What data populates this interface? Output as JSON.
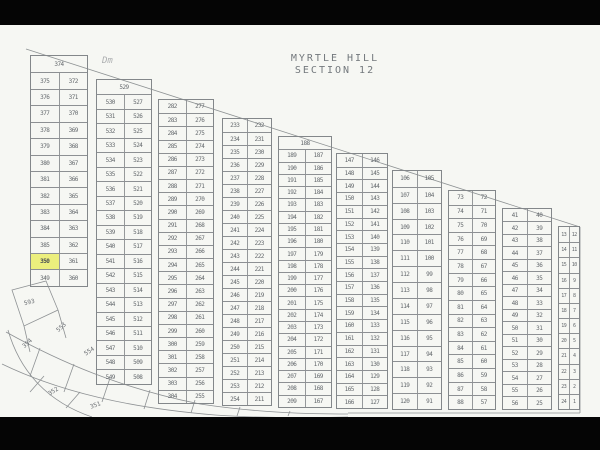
{
  "title": {
    "line1": "MYRTLE HILL",
    "line2": "SECTION 12"
  },
  "annotation": {
    "text": "Dm",
    "x": 102,
    "y": 56
  },
  "colors": {
    "paper": "#f6f7f3",
    "line": "#83878a",
    "text": "#565b60",
    "highlight": "#ecef74",
    "letterbox": "#050505"
  },
  "highlight": {
    "strip": 0,
    "row": 12,
    "col": 0,
    "lot": "350"
  },
  "strips": [
    {
      "x": 30,
      "w": 58,
      "top": 55,
      "bottom": 287,
      "fs": 6,
      "header": "374",
      "rows": [
        [
          "375",
          "372"
        ],
        [
          "376",
          "371"
        ],
        [
          "377",
          "370"
        ],
        [
          "378",
          "369"
        ],
        [
          "379",
          "368"
        ],
        [
          "380",
          "367"
        ],
        [
          "381",
          "366"
        ],
        [
          "382",
          "365"
        ],
        [
          "383",
          "364"
        ],
        [
          "384",
          "363"
        ],
        [
          "385",
          "362"
        ],
        [
          "350",
          "361"
        ],
        [
          "349",
          "360"
        ]
      ]
    },
    {
      "x": 96,
      "w": 56,
      "top": 79,
      "bottom": 385,
      "fs": 6,
      "header": "529",
      "rows": [
        [
          "530",
          "527"
        ],
        [
          "531",
          "526"
        ],
        [
          "532",
          "525"
        ],
        [
          "533",
          "524"
        ],
        [
          "534",
          "523"
        ],
        [
          "535",
          "522"
        ],
        [
          "536",
          "521"
        ],
        [
          "537",
          "520"
        ],
        [
          "538",
          "519"
        ],
        [
          "539",
          "518"
        ],
        [
          "540",
          "517"
        ],
        [
          "541",
          "516"
        ],
        [
          "542",
          "515"
        ],
        [
          "543",
          "514"
        ],
        [
          "544",
          "513"
        ],
        [
          "545",
          "512"
        ],
        [
          "546",
          "511"
        ],
        [
          "547",
          "510"
        ],
        [
          "548",
          "509"
        ],
        [
          "549",
          "508"
        ]
      ]
    },
    {
      "x": 158,
      "w": 56,
      "top": 99,
      "bottom": 404,
      "fs": 6,
      "header": "",
      "rows": [
        [
          "282",
          "277"
        ],
        [
          "283",
          "276"
        ],
        [
          "284",
          "275"
        ],
        [
          "285",
          "274"
        ],
        [
          "286",
          "273"
        ],
        [
          "287",
          "272"
        ],
        [
          "288",
          "271"
        ],
        [
          "289",
          "270"
        ],
        [
          "290",
          "269"
        ],
        [
          "291",
          "268"
        ],
        [
          "292",
          "267"
        ],
        [
          "293",
          "266"
        ],
        [
          "294",
          "265"
        ],
        [
          "295",
          "264"
        ],
        [
          "296",
          "263"
        ],
        [
          "297",
          "262"
        ],
        [
          "298",
          "261"
        ],
        [
          "299",
          "260"
        ],
        [
          "300",
          "259"
        ],
        [
          "301",
          "258"
        ],
        [
          "302",
          "257"
        ],
        [
          "303",
          "256"
        ],
        [
          "304",
          "255"
        ]
      ]
    },
    {
      "x": 222,
      "w": 50,
      "top": 118,
      "bottom": 406,
      "fs": 6,
      "header": "",
      "rows": [
        [
          "233",
          "232"
        ],
        [
          "234",
          "231"
        ],
        [
          "235",
          "230"
        ],
        [
          "236",
          "229"
        ],
        [
          "237",
          "228"
        ],
        [
          "238",
          "227"
        ],
        [
          "239",
          "226"
        ],
        [
          "240",
          "225"
        ],
        [
          "241",
          "224"
        ],
        [
          "242",
          "223"
        ],
        [
          "243",
          "222"
        ],
        [
          "244",
          "221"
        ],
        [
          "245",
          "220"
        ],
        [
          "246",
          "219"
        ],
        [
          "247",
          "218"
        ],
        [
          "248",
          "217"
        ],
        [
          "249",
          "216"
        ],
        [
          "250",
          "215"
        ],
        [
          "251",
          "214"
        ],
        [
          "252",
          "213"
        ],
        [
          "253",
          "212"
        ],
        [
          "254",
          "211"
        ]
      ]
    },
    {
      "x": 278,
      "w": 54,
      "top": 136,
      "bottom": 408,
      "fs": 6,
      "header": "188",
      "rows": [
        [
          "189",
          "187"
        ],
        [
          "190",
          "186"
        ],
        [
          "191",
          "185"
        ],
        [
          "192",
          "184"
        ],
        [
          "193",
          "183"
        ],
        [
          "194",
          "182"
        ],
        [
          "195",
          "181"
        ],
        [
          "196",
          "180"
        ],
        [
          "197",
          "179"
        ],
        [
          "198",
          "178"
        ],
        [
          "199",
          "177"
        ],
        [
          "200",
          "176"
        ],
        [
          "201",
          "175"
        ],
        [
          "202",
          "174"
        ],
        [
          "203",
          "173"
        ],
        [
          "204",
          "172"
        ],
        [
          "205",
          "171"
        ],
        [
          "206",
          "170"
        ],
        [
          "207",
          "169"
        ],
        [
          "208",
          "168"
        ],
        [
          "209",
          "167"
        ]
      ]
    },
    {
      "x": 336,
      "w": 52,
      "top": 153,
      "bottom": 409,
      "fs": 6,
      "header": "",
      "rows": [
        [
          "147",
          "146"
        ],
        [
          "148",
          "145"
        ],
        [
          "149",
          "144"
        ],
        [
          "150",
          "143"
        ],
        [
          "151",
          "142"
        ],
        [
          "152",
          "141"
        ],
        [
          "153",
          "140"
        ],
        [
          "154",
          "139"
        ],
        [
          "155",
          "138"
        ],
        [
          "156",
          "137"
        ],
        [
          "157",
          "136"
        ],
        [
          "158",
          "135"
        ],
        [
          "159",
          "134"
        ],
        [
          "160",
          "133"
        ],
        [
          "161",
          "132"
        ],
        [
          "162",
          "131"
        ],
        [
          "163",
          "130"
        ],
        [
          "164",
          "129"
        ],
        [
          "165",
          "128"
        ],
        [
          "166",
          "127"
        ]
      ]
    },
    {
      "x": 392,
      "w": 50,
      "top": 170,
      "bottom": 410,
      "fs": 6,
      "header": "",
      "rows": [
        [
          "106",
          "105"
        ],
        [
          "107",
          "104"
        ],
        [
          "108",
          "103"
        ],
        [
          "109",
          "102"
        ],
        [
          "110",
          "101"
        ],
        [
          "111",
          "100"
        ],
        [
          "112",
          "99"
        ],
        [
          "113",
          "98"
        ],
        [
          "114",
          "97"
        ],
        [
          "115",
          "96"
        ],
        [
          "116",
          "95"
        ],
        [
          "117",
          "94"
        ],
        [
          "118",
          "93"
        ],
        [
          "119",
          "92"
        ],
        [
          "120",
          "91"
        ]
      ]
    },
    {
      "x": 448,
      "w": 48,
      "top": 190,
      "bottom": 410,
      "fs": 6,
      "header": "",
      "rows": [
        [
          "73",
          "72"
        ],
        [
          "74",
          "71"
        ],
        [
          "75",
          "70"
        ],
        [
          "76",
          "69"
        ],
        [
          "77",
          "68"
        ],
        [
          "78",
          "67"
        ],
        [
          "79",
          "66"
        ],
        [
          "80",
          "65"
        ],
        [
          "81",
          "64"
        ],
        [
          "82",
          "63"
        ],
        [
          "83",
          "62"
        ],
        [
          "84",
          "61"
        ],
        [
          "85",
          "60"
        ],
        [
          "86",
          "59"
        ],
        [
          "87",
          "58"
        ],
        [
          "88",
          "57"
        ]
      ]
    },
    {
      "x": 502,
      "w": 50,
      "top": 208,
      "bottom": 410,
      "fs": 6,
      "header": "",
      "rows": [
        [
          "41",
          "40"
        ],
        [
          "42",
          "39"
        ],
        [
          "43",
          "38"
        ],
        [
          "44",
          "37"
        ],
        [
          "45",
          "36"
        ],
        [
          "46",
          "35"
        ],
        [
          "47",
          "34"
        ],
        [
          "48",
          "33"
        ],
        [
          "49",
          "32"
        ],
        [
          "50",
          "31"
        ],
        [
          "51",
          "30"
        ],
        [
          "52",
          "29"
        ],
        [
          "53",
          "28"
        ],
        [
          "54",
          "27"
        ],
        [
          "55",
          "26"
        ],
        [
          "56",
          "25"
        ]
      ]
    },
    {
      "x": 558,
      "w": 22,
      "top": 226,
      "bottom": 410,
      "fs": 5,
      "header": "",
      "rows": [
        [
          "13",
          "12"
        ],
        [
          "14",
          "11"
        ],
        [
          "15",
          "10"
        ],
        [
          "16",
          "9"
        ],
        [
          "17",
          "8"
        ],
        [
          "18",
          "7"
        ],
        [
          "19",
          "6"
        ],
        [
          "20",
          "5"
        ],
        [
          "21",
          "4"
        ],
        [
          "22",
          "3"
        ],
        [
          "23",
          "2"
        ],
        [
          "24",
          "1"
        ]
      ]
    }
  ],
  "road_lots": [
    {
      "label": "593",
      "x": 24,
      "y": 299,
      "rot": -14
    },
    {
      "label": "354",
      "x": 22,
      "y": 340,
      "rot": -42
    },
    {
      "label": "553",
      "x": 56,
      "y": 324,
      "rot": -42
    },
    {
      "label": "554",
      "x": 84,
      "y": 348,
      "rot": -34
    },
    {
      "label": "352",
      "x": 48,
      "y": 388,
      "rot": -32
    },
    {
      "label": "351",
      "x": 90,
      "y": 402,
      "rot": -20
    }
  ]
}
